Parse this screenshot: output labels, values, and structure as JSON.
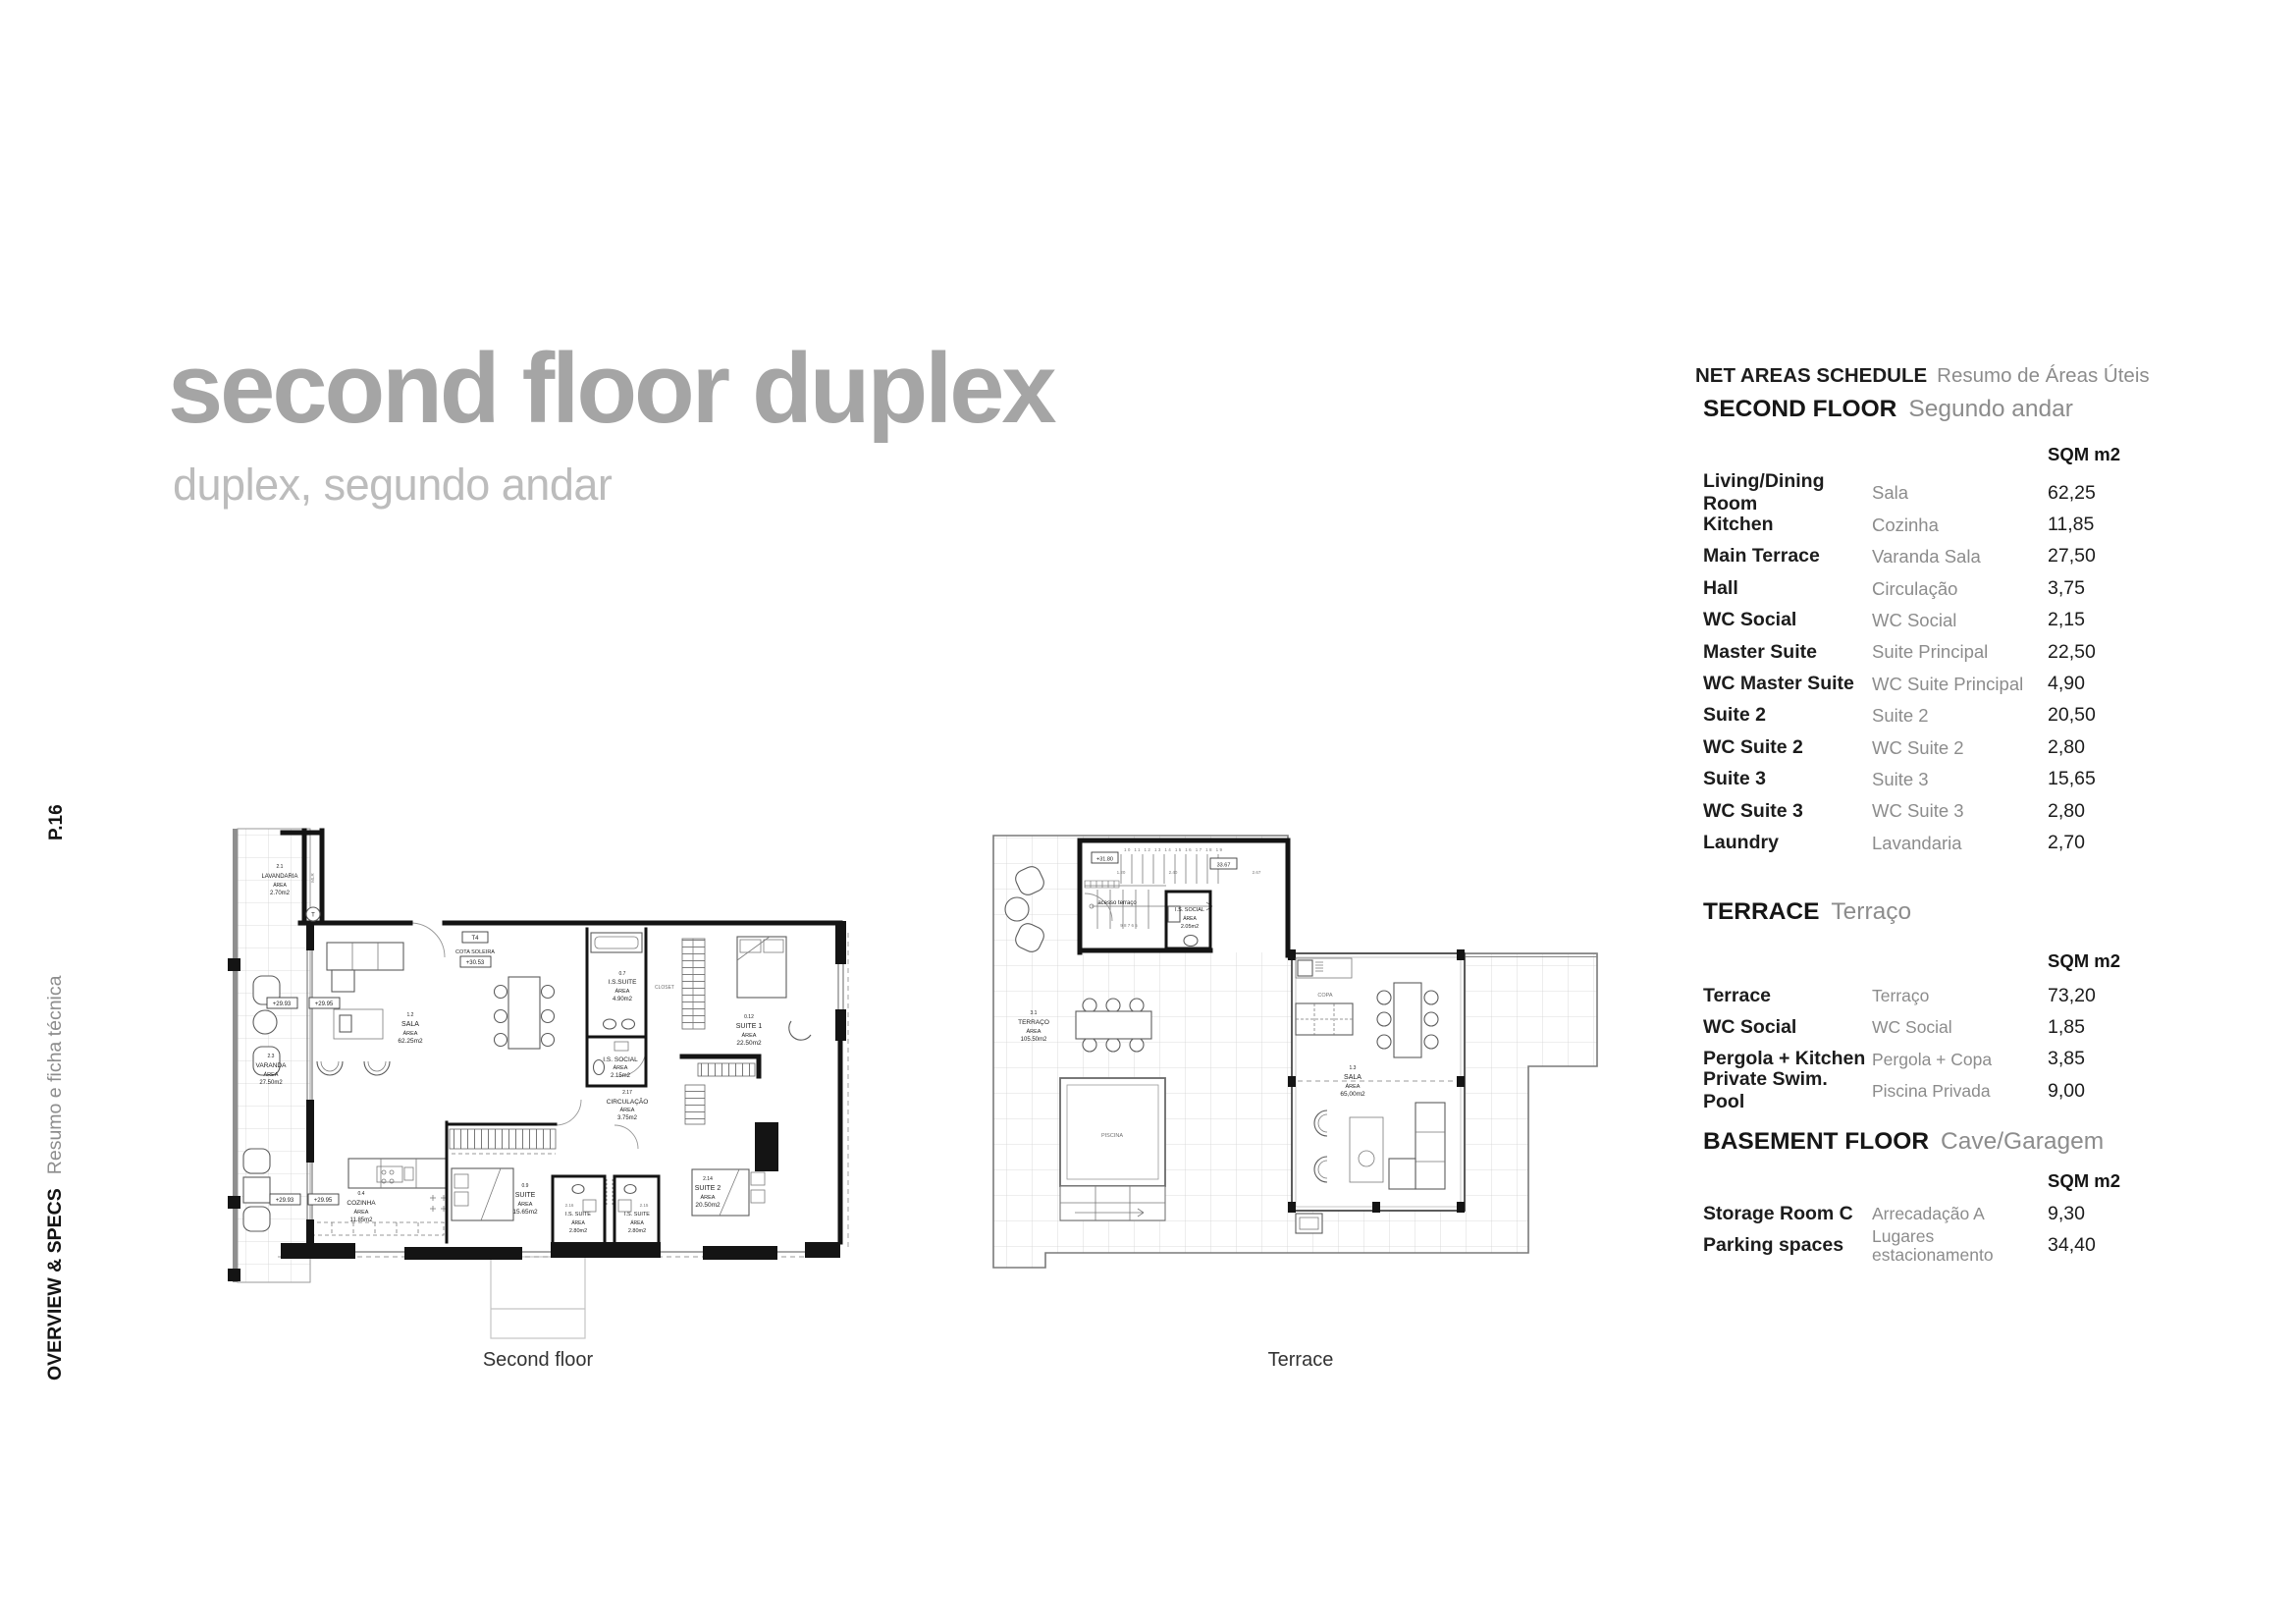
{
  "sidebar": {
    "page_ref": "P.16",
    "section_en": "OVERVIEW & SPECS",
    "section_pt": "Resumo e ficha técnica"
  },
  "header": {
    "title": "second floor duplex",
    "subtitle": "duplex, segundo andar",
    "title_color": "#a5a5a5",
    "subtitle_color": "#bcbcbc"
  },
  "schedule": {
    "title_en": "NET AREAS SCHEDULE",
    "title_pt": "Resumo de Áreas Úteis",
    "unit": "SQM m2",
    "sections": [
      {
        "en": "SECOND FLOOR",
        "pt": "Segundo andar",
        "rows": [
          {
            "en": "Living/Dining Room",
            "pt": "Sala",
            "sqm": "62,25"
          },
          {
            "en": "Kitchen",
            "pt": "Cozinha",
            "sqm": "11,85"
          },
          {
            "en": "Main Terrace",
            "pt": "Varanda Sala",
            "sqm": "27,50"
          },
          {
            "en": "Hall",
            "pt": "Circulação",
            "sqm": "3,75"
          },
          {
            "en": "WC Social",
            "pt": "WC Social",
            "sqm": "2,15"
          },
          {
            "en": "Master Suite",
            "pt": "Suite Principal",
            "sqm": "22,50"
          },
          {
            "en": "WC Master Suite",
            "pt": "WC Suite Principal",
            "sqm": "4,90"
          },
          {
            "en": "Suite 2",
            "pt": "Suite 2",
            "sqm": "20,50"
          },
          {
            "en": "WC Suite 2",
            "pt": "WC Suite 2",
            "sqm": "2,80"
          },
          {
            "en": "Suite 3",
            "pt": "Suite 3",
            "sqm": "15,65"
          },
          {
            "en": "WC Suite 3",
            "pt": "WC Suite 3",
            "sqm": "2,80"
          },
          {
            "en": "Laundry",
            "pt": "Lavandaria",
            "sqm": "2,70"
          }
        ]
      },
      {
        "en": "TERRACE",
        "pt": "Terraço",
        "rows": [
          {
            "en": "Terrace",
            "pt": "Terraço",
            "sqm": "73,20"
          },
          {
            "en": "WC Social",
            "pt": "WC Social",
            "sqm": "1,85"
          },
          {
            "en": "Pergola + Kitchen",
            "pt": "Pergola + Copa",
            "sqm": "3,85"
          },
          {
            "en": "Private Swim. Pool",
            "pt": "Piscina Privada",
            "sqm": "9,00"
          }
        ]
      },
      {
        "en": "BASEMENT FLOOR",
        "pt": "Cave/Garagem",
        "rows": [
          {
            "en": "Storage Room C",
            "pt": "Arrecadação A",
            "sqm": "9,30"
          },
          {
            "en": "Parking spaces",
            "pt": "Lugares estacionamento",
            "sqm": "34,40"
          }
        ]
      }
    ]
  },
  "plans": {
    "p1": {
      "caption": "Second floor",
      "labels": [
        "2.1",
        "LAVANDARIA",
        "ÁREA",
        "2.70m2",
        "MLR",
        "T",
        "T4",
        "COTA SOLEIRA",
        "+30.53",
        "+29.93",
        "+29.95",
        "1.2",
        "SALA",
        "ÁREA",
        "62.25m2",
        "2.3",
        "VARANDA",
        "ÁREA",
        "27.50m2",
        "0.7",
        "I.S.SUITE",
        "ÁREA",
        "4.90m2",
        "CLOSET",
        "0.12",
        "SUITE 1",
        "ÁREA",
        "22.50m2",
        "I.S. SOCIAL",
        "ÁREA",
        "2.15m2",
        "2.17",
        "CIRCULAÇÃO",
        "ÁREA",
        "3.75m2",
        "0.4",
        "COZINHA",
        "ÁREA",
        "11.85m2",
        "0.9",
        "SUITE",
        "ÁREA",
        "15.65m2",
        "2.16",
        "I.S. SUITE",
        "ÁREA",
        "2.80m2",
        "2.15",
        "I.S. SUITE",
        "ÁREA",
        "2.80m2",
        "2.14",
        "SUITE 2",
        "ÁREA",
        "20.50m2",
        "+29.93",
        "+29.95"
      ]
    },
    "p2": {
      "caption": "Terrace",
      "labels": [
        "+31.80",
        "33.67",
        "1.20",
        "2.40",
        "2.67",
        "acesso terraço",
        "I.S. SOCIAL",
        "ÁREA",
        "2.05m2",
        "3.1",
        "TERRAÇO",
        "ÁREA",
        "105.50m2",
        "PISCINA",
        "COPA",
        "1.3",
        "SALA",
        "ÁREA",
        "65,00m2",
        "10 11 12 13 14 15 16 17 18 19",
        "9 8 7 6 5"
      ]
    }
  }
}
